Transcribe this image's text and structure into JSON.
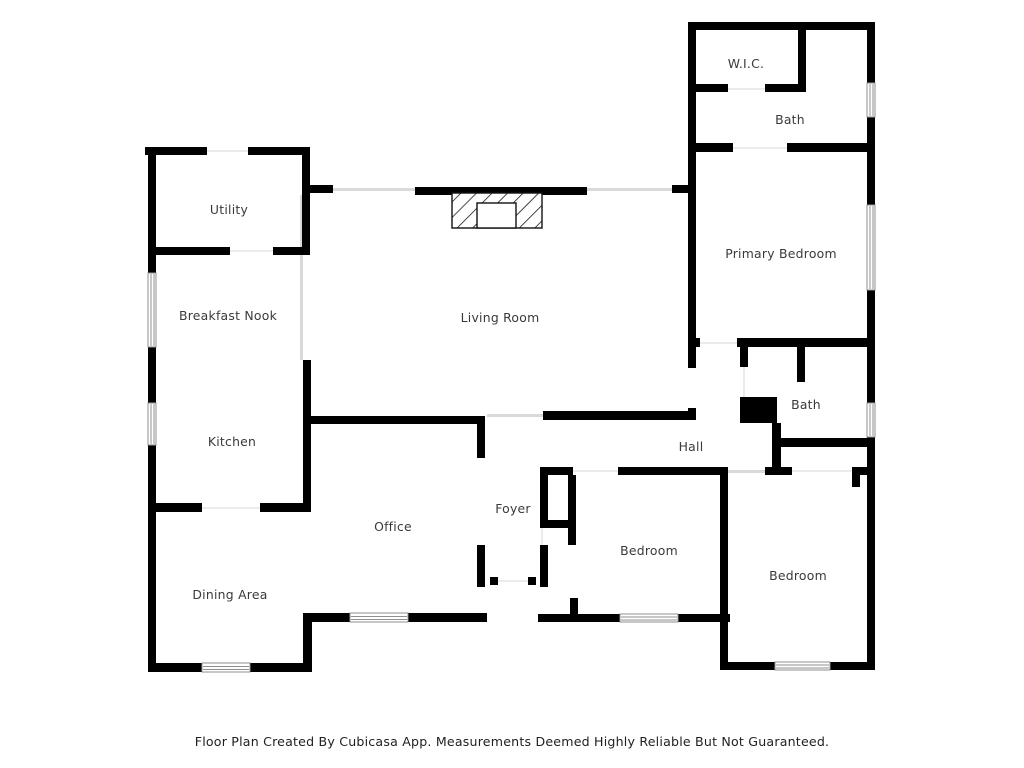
{
  "plan": {
    "title": "Residential Floor Plan",
    "footer_note": "Floor Plan Created By Cubicasa App. Measurements Deemed Highly Reliable But Not Guaranteed.",
    "rooms": [
      {
        "label": "W.I.C."
      },
      {
        "label": "Bath"
      },
      {
        "label": "Primary Bedroom"
      },
      {
        "label": "Utility"
      },
      {
        "label": "Breakfast Nook"
      },
      {
        "label": "Living Room"
      },
      {
        "label": "Kitchen"
      },
      {
        "label": "Hall"
      },
      {
        "label": "Bath"
      },
      {
        "label": "Foyer"
      },
      {
        "label": "Office"
      },
      {
        "label": "Dining Area"
      },
      {
        "label": "Bedroom"
      },
      {
        "label": "Bedroom"
      }
    ],
    "symbols": {
      "fireplace": "hatched-fireplace-with-firebox",
      "bath_fixture": "solid-black-fixture",
      "window": "double-line-window",
      "opening": "thin-gray-opening-line"
    },
    "colors": {
      "wall": "#000000",
      "background": "#ffffff",
      "label": "#3a3a3a",
      "opening_line": "#d9d9d9",
      "threshold_line": "#ebebeb",
      "window_frame": "#8f8f8f",
      "footer_text": "#1f1f1f"
    }
  }
}
